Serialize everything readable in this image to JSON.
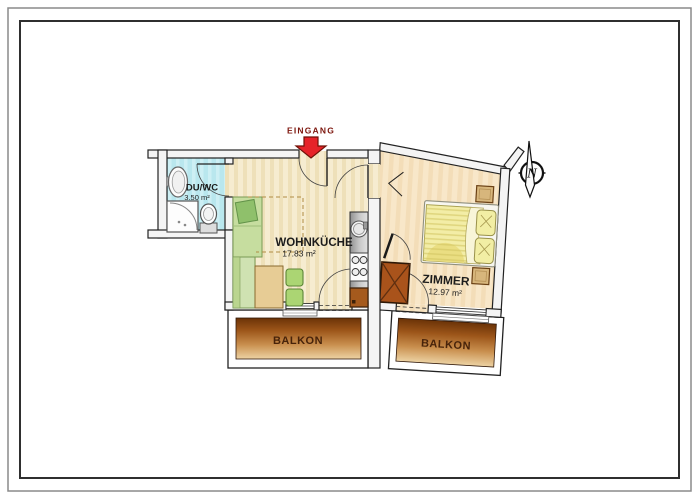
{
  "entrance": {
    "label": "EINGANG"
  },
  "compass": {
    "label": "N"
  },
  "rooms": {
    "bath": {
      "name": "DU/WC",
      "area": "3.50 m²"
    },
    "living": {
      "name": "WOHNKÜCHE",
      "area": "17.83 m²"
    },
    "bedroom": {
      "name": "ZIMMER",
      "area": "12.97 m²"
    }
  },
  "balconies": {
    "left": {
      "name": "BALKON"
    },
    "right": {
      "name": "BALKON"
    }
  },
  "colors": {
    "entrance_arrow": "#e62329",
    "entrance_text": "#7c150c",
    "bath_floor": "#b9e7ee",
    "living_floor": "#f6ecd0",
    "bedroom_floor": "#f8e7c9",
    "balcony_dark": "#6b3307",
    "balcony_light": "#edd3a4",
    "balcony_text": "#47230a",
    "furniture_green": "#c6dd9f",
    "chair_green": "#abd573",
    "bed_yellow": "#f3eda6",
    "wood_brown": "#a9531b",
    "wall_fill": "#f4f4f4"
  }
}
